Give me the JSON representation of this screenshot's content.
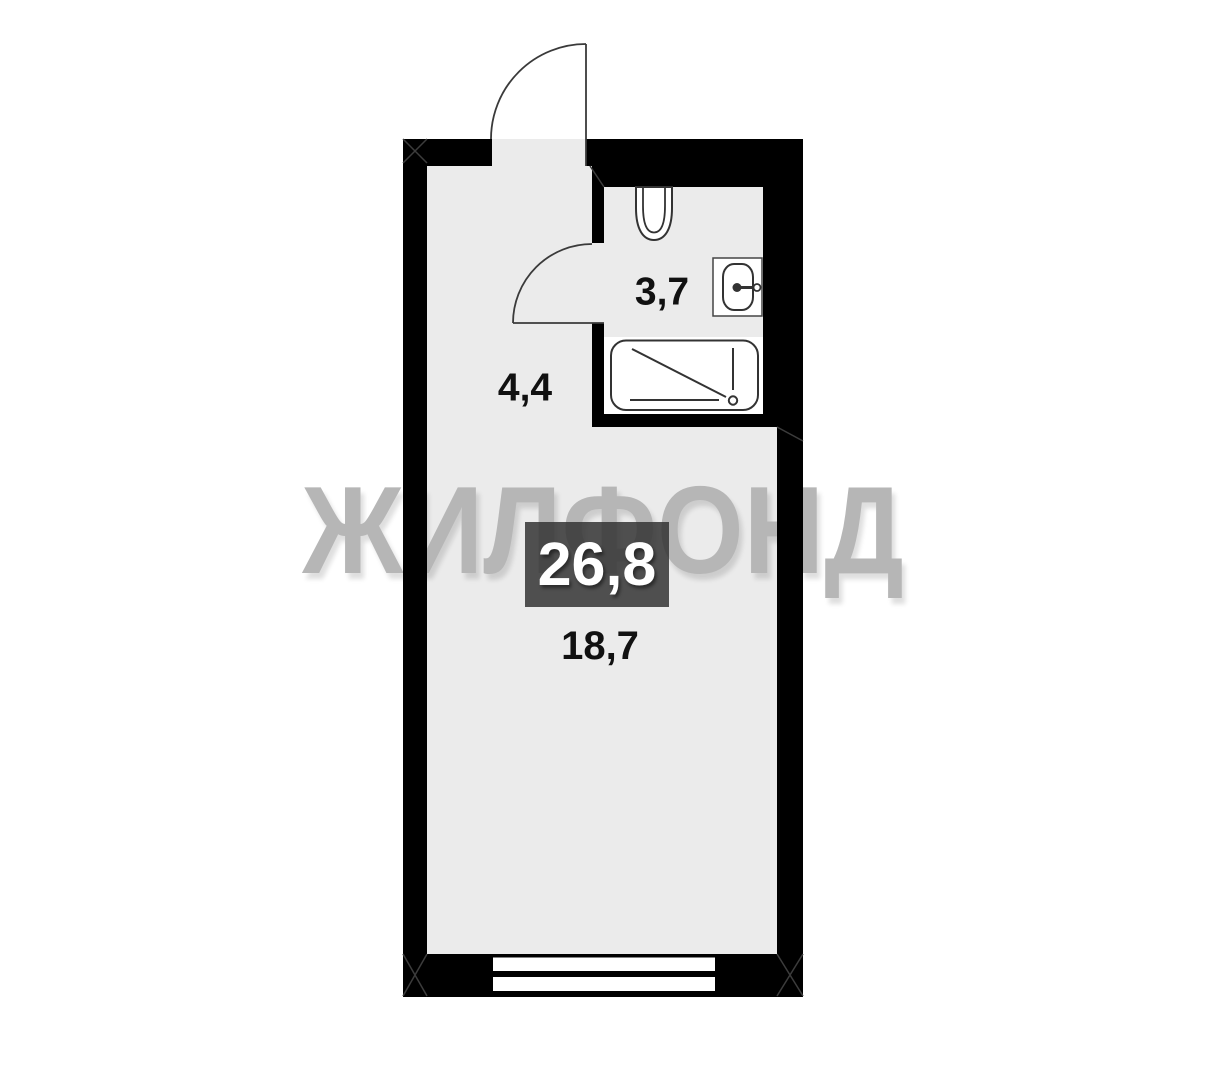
{
  "plan": {
    "watermark": "ЖИЛФОНД",
    "total_area": "26,8",
    "areas": {
      "bathroom": "3,7",
      "hallway": "4,4",
      "living_room": "18,7"
    },
    "fixtures": [
      "entrance-door",
      "interior-door",
      "toilet",
      "sink",
      "bathtub",
      "window"
    ],
    "colors": {
      "background": "#ffffff",
      "floor": "#ebebeb",
      "wall": "#000000",
      "badge_bg": "#4a4a4a",
      "badge_text": "#ffffff",
      "watermark": "#b6b6b6",
      "label_text": "#111111",
      "fixture_line": "#333333"
    }
  }
}
